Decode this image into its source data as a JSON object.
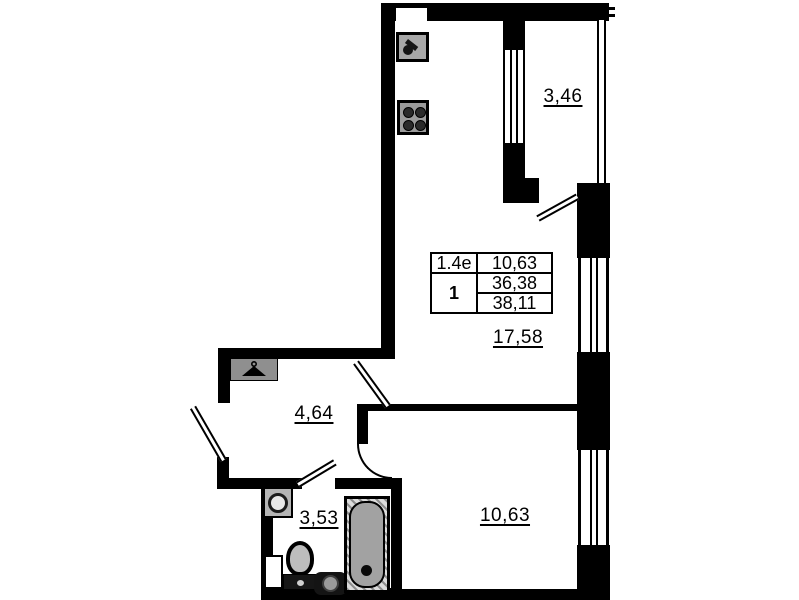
{
  "rooms": {
    "balcony": "3,46",
    "living_kitchen": "17,58",
    "hallway": "4,64",
    "bathroom": "3,53",
    "bedroom": "10,63"
  },
  "info_table": {
    "type_code": "1.4е",
    "room_count": "1",
    "living_area": "10,63",
    "area_excl_balcony": "36,38",
    "total_area": "38,11"
  },
  "icons": {
    "kitchen_sink": "kitchen-sink-icon",
    "stove": "stove-icon",
    "wardrobe": "wardrobe-hanger-icon",
    "bath_sink": "bath-sink-icon",
    "toilet": "toilet-icon",
    "washing_machine": "washing-machine-icon",
    "bathtub": "bathtub-icon"
  },
  "colors": {
    "wall": "#000000",
    "background": "#ffffff",
    "fixture_fill": "#a8a8a8",
    "fixture_dark": "#1e1e1e"
  }
}
